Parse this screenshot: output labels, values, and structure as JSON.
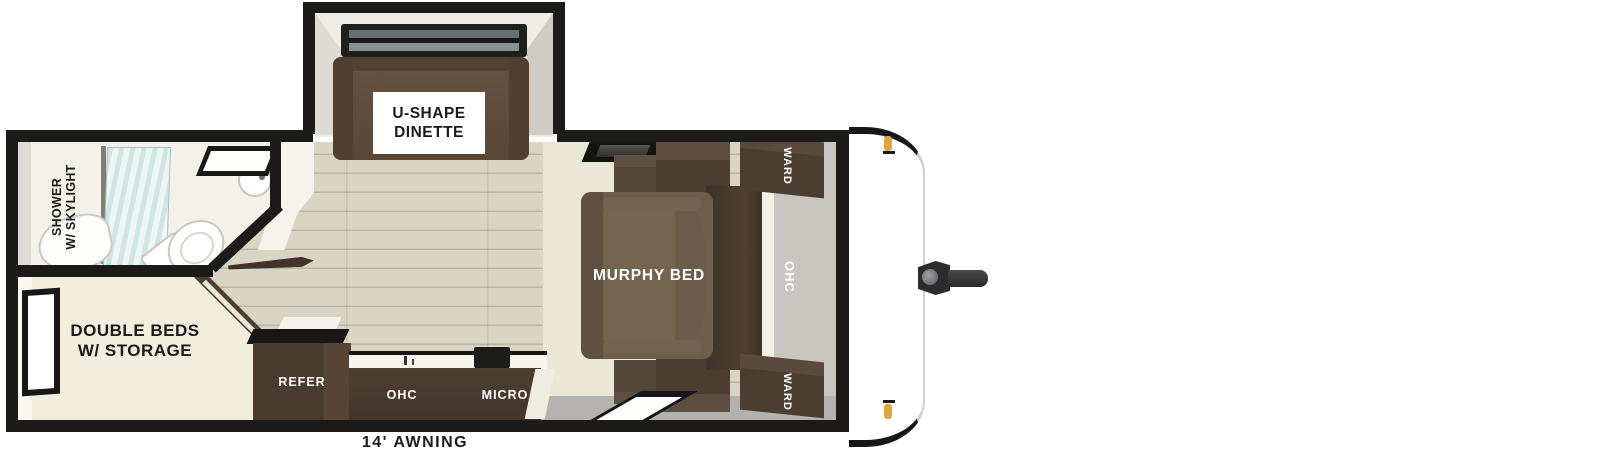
{
  "labels": {
    "dinette_line1": "U-SHAPE",
    "dinette_line2": "DINETTE",
    "shower_line1": "SHOWER",
    "shower_line2": "W/ SKYLIGHT",
    "double_beds_line1": "DOUBLE BEDS",
    "double_beds_line2": "W/ STORAGE",
    "murphy_bed": "MURPHY BED",
    "ward_top": "WARD",
    "ward_bottom": "WARD",
    "ohc_front": "OHC",
    "refer": "REFER",
    "ohc_kitchen": "OHC",
    "micro": "MICRO",
    "awning": "14' AWNING"
  },
  "colors": {
    "wall": "#1d1b19",
    "wood": "#d9d5c3",
    "cream": "#f2eede",
    "platform_cream": "#ebe7d6",
    "bath_white": "#f3f1e9",
    "gray_wall": "#c8c6c1",
    "gray_floor": "#b3b2ae",
    "cabinet": "#4c3d31",
    "cabinet_light": "#5d4d3f",
    "bed_brown": "#6e5e4c",
    "bed_brown_light": "#75654f",
    "dinette_brown": "#5f4c3b",
    "glass": "#cfe5e4",
    "amber": "#e2a43c",
    "label_dark": "#1b1a18"
  }
}
